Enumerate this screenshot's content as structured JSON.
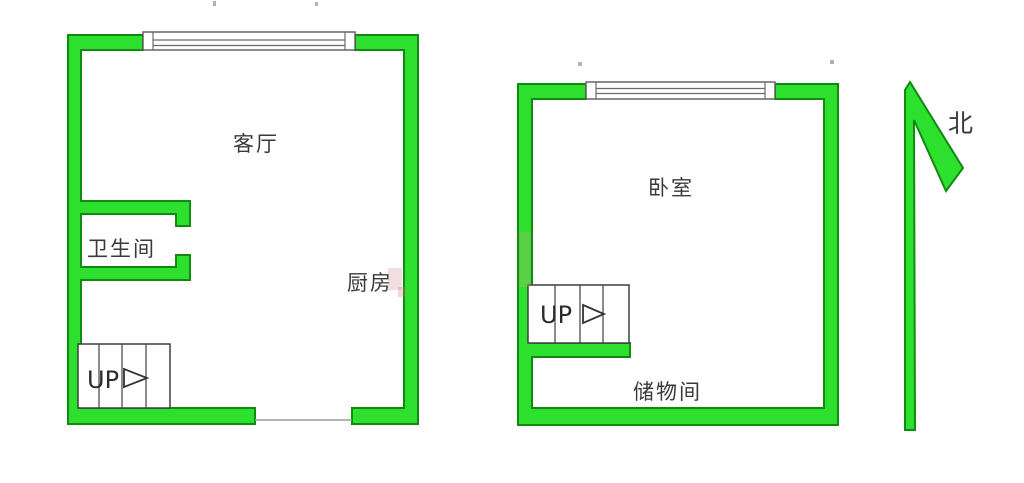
{
  "image_type": "residential floor plan, two levels side by side",
  "colors": {
    "wall_fill": "#2ee02e",
    "wall_outline": "#128a12",
    "detail_line": "#3f3f3f",
    "text": "#3a3a3a",
    "background": "#ffffff"
  },
  "left_plan": {
    "rooms": {
      "living_room": "客厅",
      "bathroom": "卫生间",
      "kitchen": "厨房"
    },
    "stairs_label": "UP"
  },
  "right_plan": {
    "rooms": {
      "bedroom": "卧室",
      "storage": "储物间"
    },
    "stairs_label": "UP"
  },
  "compass": {
    "north": "北"
  }
}
